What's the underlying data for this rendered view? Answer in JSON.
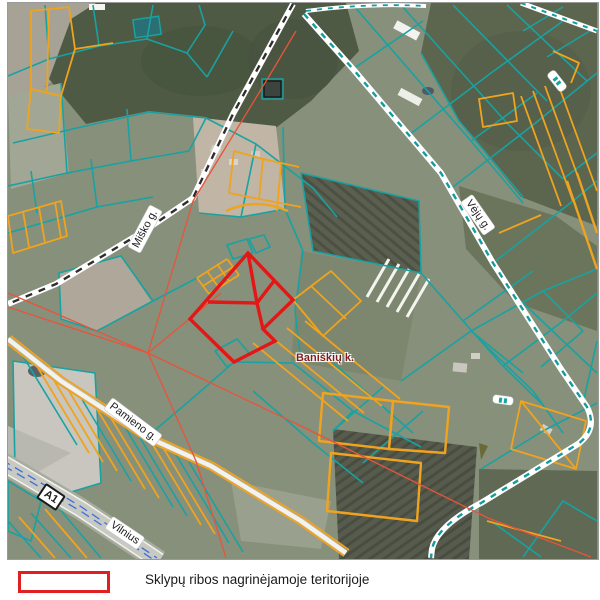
{
  "map": {
    "street_labels": {
      "misko": "Miško g.",
      "veju": "Vėjų g.",
      "pamieno": "Pamieno g."
    },
    "route_labels": {
      "a1": "A1",
      "vilnius": "Vilnius"
    },
    "place_labels": {
      "village": "Baniškių k."
    },
    "colors": {
      "parcel_teal": "#18a2a2",
      "parcel_orange": "#efa31f",
      "subject_red": "#e51616",
      "line_red": "#e8543a",
      "highway_blue": "#3a6fd8",
      "village_label": "#7a1f1f",
      "legend_red": "#e02020"
    }
  },
  "legend": {
    "items": [
      {
        "label": "Sklypų ribos nagrinėjamoje teritorijoje"
      }
    ]
  }
}
